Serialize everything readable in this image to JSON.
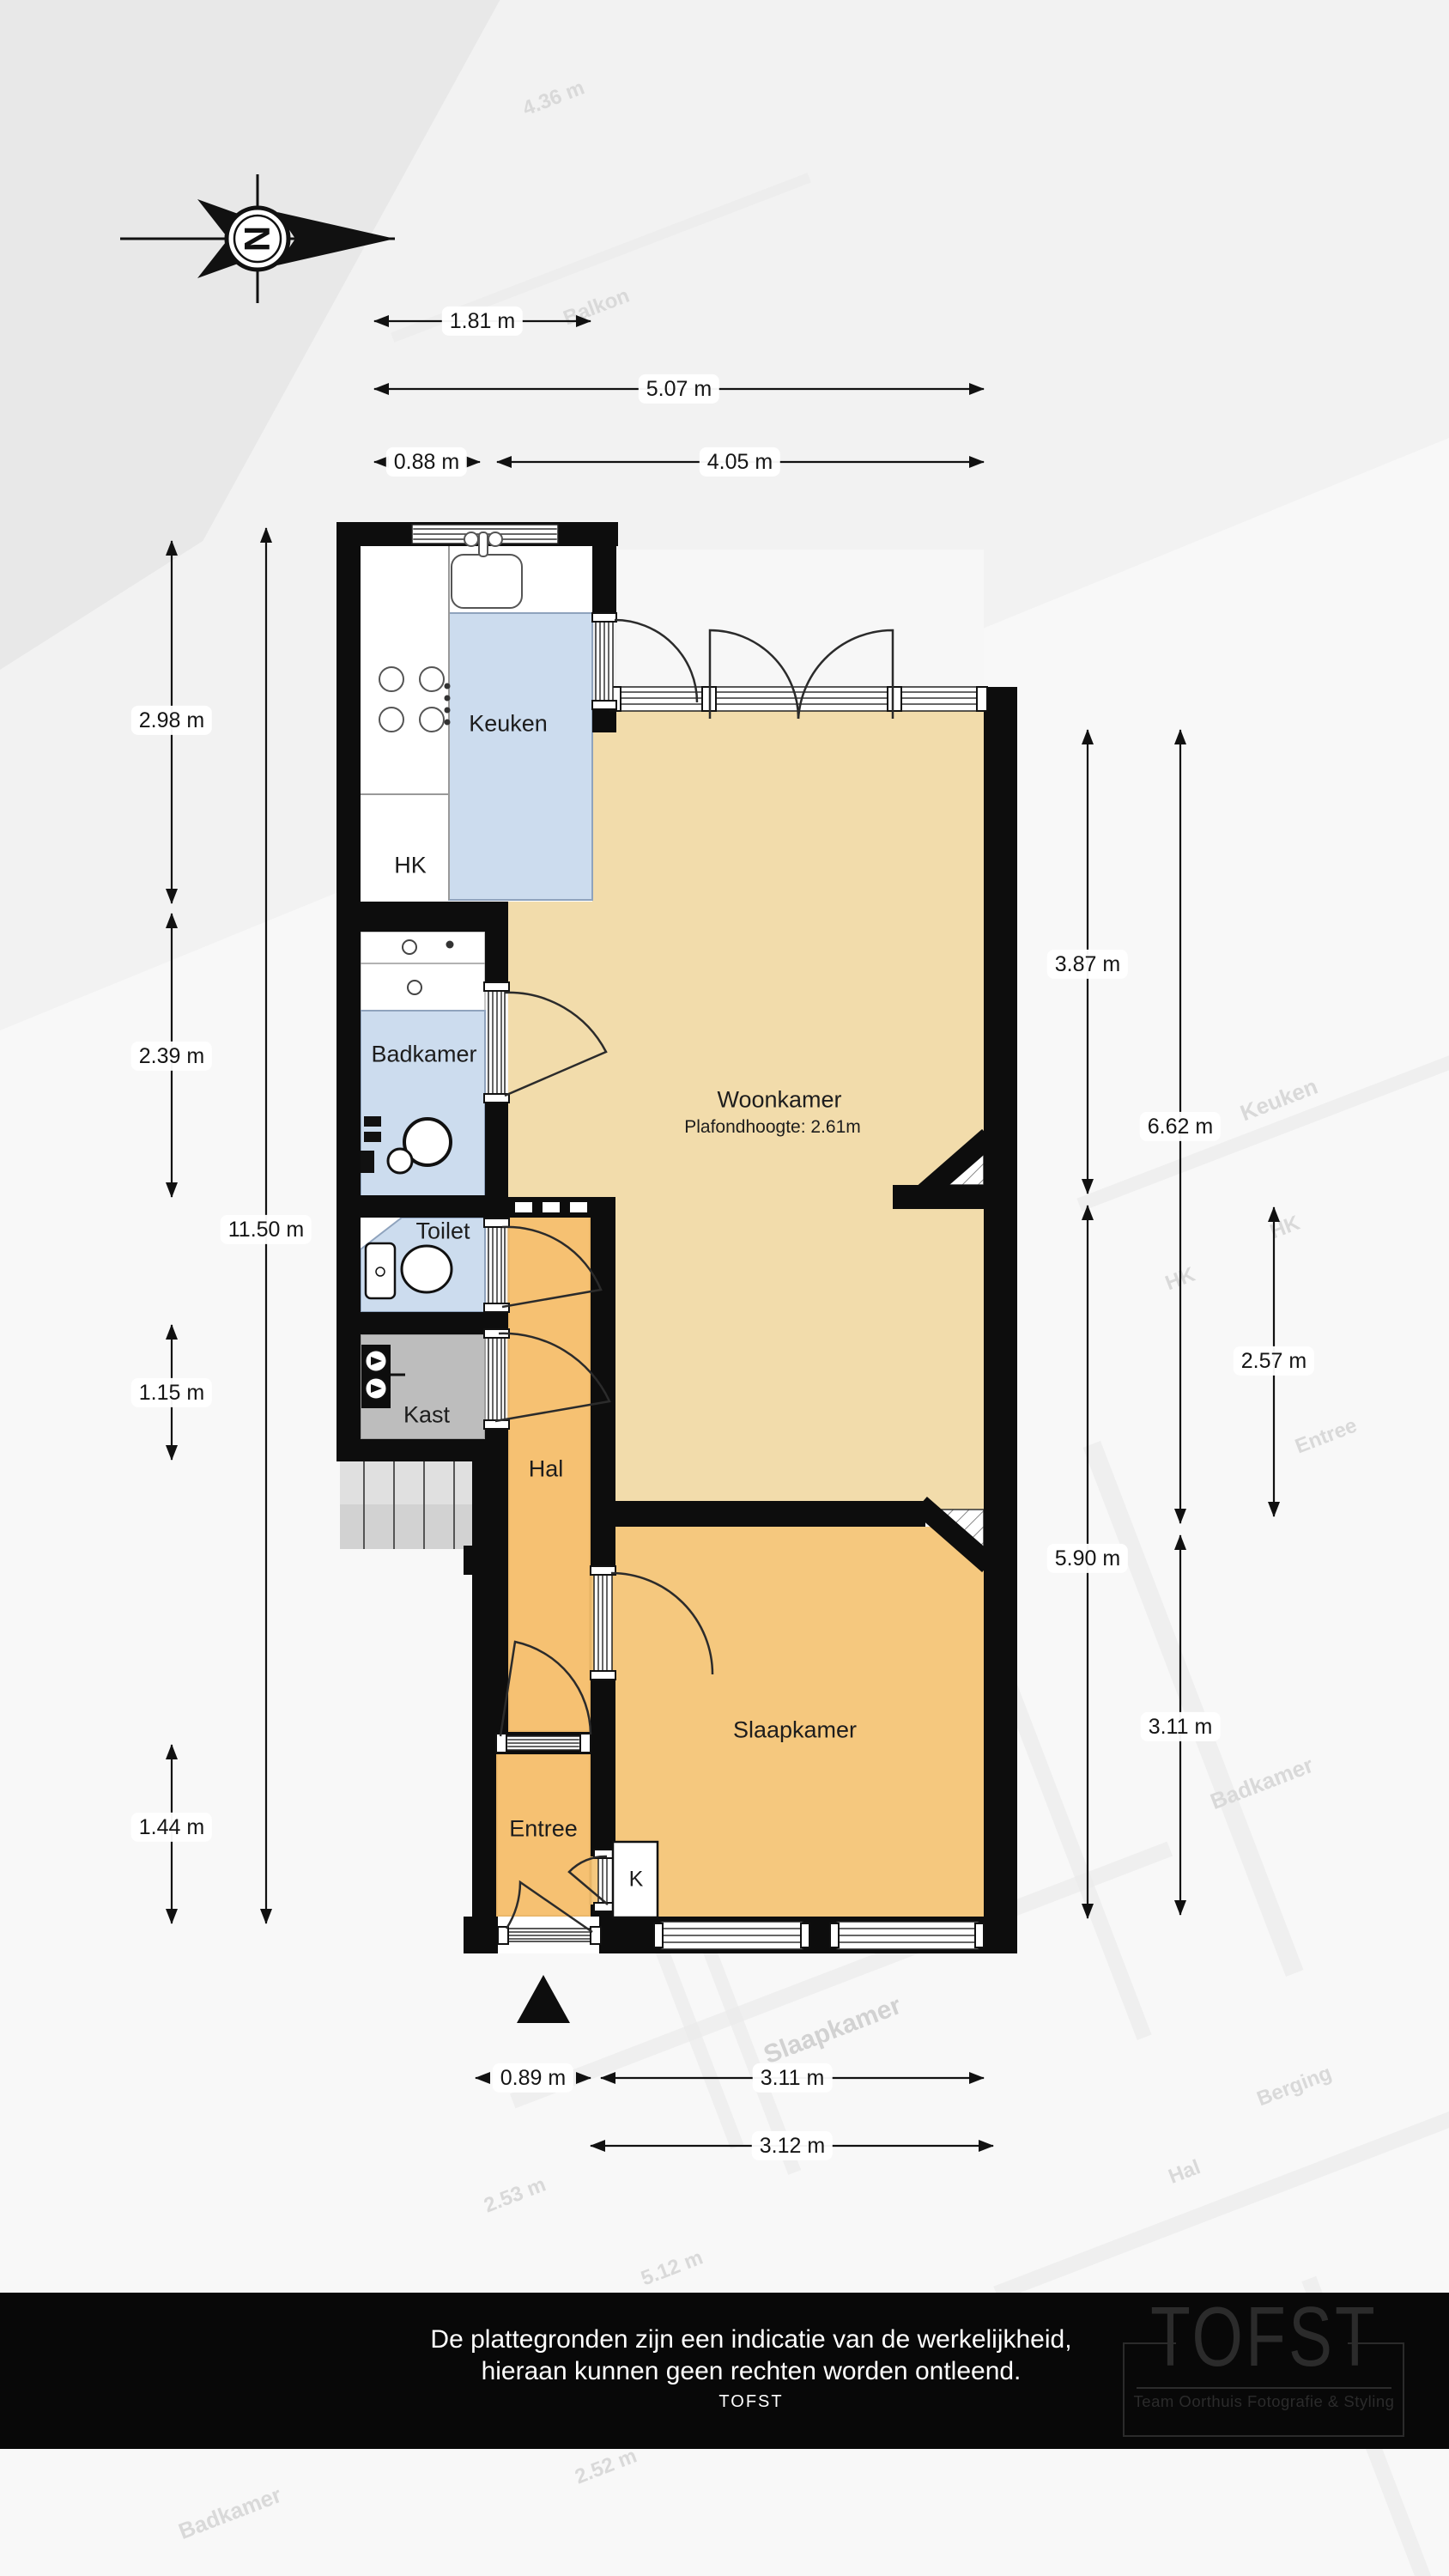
{
  "compass": {
    "letter": "N"
  },
  "plan": {
    "rooms": {
      "keuken": {
        "label": "Keuken"
      },
      "hk": {
        "label": "HK"
      },
      "badkamer": {
        "label": "Badkamer"
      },
      "toilet": {
        "label": "Toilet"
      },
      "kast": {
        "label": "Kast"
      },
      "hal": {
        "label": "Hal"
      },
      "entree": {
        "label": "Entree"
      },
      "k": {
        "label": "K"
      },
      "woonkamer": {
        "label": "Woonkamer",
        "ceiling_note": "Plafondhoogte: 2.61m"
      },
      "slaapkamer": {
        "label": "Slaapkamer"
      }
    },
    "dimensions": {
      "top": [
        {
          "label": "1.81 m"
        },
        {
          "label": "5.07 m"
        },
        {
          "label": "0.88 m"
        },
        {
          "label": "4.05 m"
        }
      ],
      "left": [
        {
          "label": "2.98 m"
        },
        {
          "label": "2.39 m"
        },
        {
          "label": "11.50 m"
        },
        {
          "label": "1.15 m"
        },
        {
          "label": "1.44 m"
        }
      ],
      "right": [
        {
          "label": "3.87 m"
        },
        {
          "label": "6.62 m"
        },
        {
          "label": "2.57 m"
        },
        {
          "label": "5.90 m"
        },
        {
          "label": "3.11 m"
        }
      ],
      "bottom": [
        {
          "label": "0.89 m"
        },
        {
          "label": "3.11 m"
        },
        {
          "label": "3.12 m"
        }
      ]
    }
  },
  "watermark": {
    "labels": [
      {
        "text": "Balkon"
      },
      {
        "text": "4.36 m"
      },
      {
        "text": "Keuken"
      },
      {
        "text": "HK"
      },
      {
        "text": "HK"
      },
      {
        "text": "Entree"
      },
      {
        "text": "Badkamer"
      },
      {
        "text": "Slaapkamer"
      },
      {
        "text": "Berging"
      },
      {
        "text": "Hal"
      },
      {
        "text": "Kast"
      },
      {
        "text": "2.53 m"
      },
      {
        "text": "5.12 m"
      },
      {
        "text": "2.52 m"
      },
      {
        "text": "Badkamer"
      }
    ]
  },
  "footer": {
    "disclaimer_line1": "De plattegronden zijn een indicatie van de werkelijkheid,",
    "disclaimer_line2": "hieraan kunnen geen rechten worden ontleend.",
    "brand": "TOFST"
  },
  "logo": {
    "title": "TOFST",
    "subtitle": "Team Oorthuis Fotografie & Styling"
  },
  "colors": {
    "wall": "#0d0d0d",
    "living_room_floor": "#f2dcab",
    "bedroom_floor": "#f5c87e",
    "hall_floor": "#f6c172",
    "wet_room_floor": "#ccdcee",
    "closet_floor": "#bdbdbd",
    "footer_bg": "#080808"
  }
}
